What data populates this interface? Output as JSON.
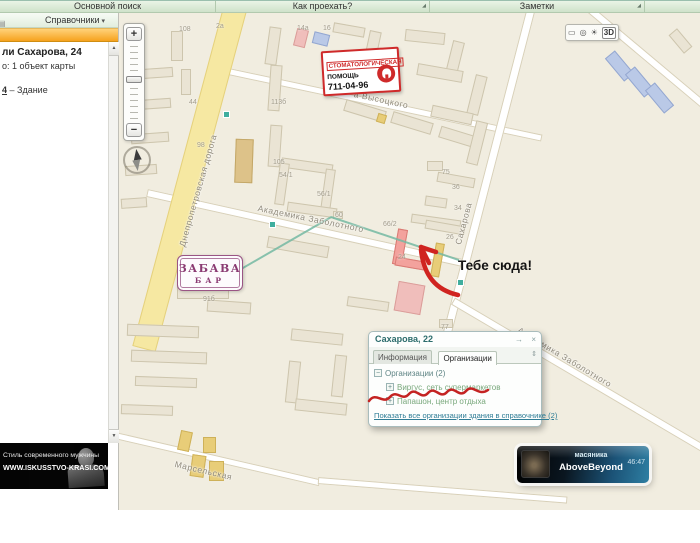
{
  "colors": {
    "accent_orange": "#f6a21d",
    "annotation_red": "#d02420",
    "selection_pink": "#f3a29d",
    "main_road_yellow": "#f6e8a2",
    "org_green": "#79a87c",
    "link_teal": "#2f7d96",
    "player_teal": "#2e7fa3"
  },
  "icons": {
    "launcher": "◢",
    "panel": "▤",
    "scroll_up": "▲",
    "scroll_down": "▼",
    "dropdown": "▾",
    "ruler": "▭",
    "dial": "◎",
    "globe": "☀",
    "route": "→",
    "close": "×",
    "sort": "⇕",
    "group_collapse": "−",
    "group_expand": "+"
  },
  "top_tabs": {
    "items": [
      "Основной поиск",
      "Как проехать?",
      "Заметки"
    ]
  },
  "sidebar": {
    "header": "Справочники",
    "result_title": "ли Сахарова, 24",
    "result_count": "о: 1 объект карты",
    "link_number": "4",
    "link_rest": " – Здание"
  },
  "ad": {
    "line1": "Стиль современного мужчины",
    "line2": "WWW.ISKUSSTVO-KRASI.COM"
  },
  "player": {
    "track": "масяника",
    "artist": "AboveBeyond",
    "time": "46:47"
  },
  "dental": {
    "line1": "СТОМАТОЛОГИЧЕСКАЯ",
    "line2": "ПОМОЩЬ",
    "phone": "711-04-96"
  },
  "zabava": {
    "title": "ЗАБАВА",
    "subtitle": "БАР"
  },
  "annotation": {
    "text": "Тебе сюда!"
  },
  "popup": {
    "title": "Сахарова, 22",
    "tabs": [
      "Информация",
      "Организации"
    ],
    "group_label": "Организации (2)",
    "orgs": [
      "Виргус, сеть супермаркетов",
      "Папашон, центр отдыха"
    ],
    "footer_link": "Показать все организации здания в справочнике (2)"
  },
  "map": {
    "controls": {
      "zoom_in": "+",
      "zoom_out": "−",
      "mode_3d": "3D"
    },
    "streets": [
      {
        "text": "Днепропетровская дорога",
        "x": 58,
        "y": 232,
        "rot": -74
      },
      {
        "text": "а Высоцкого",
        "x": 236,
        "y": 76,
        "rot": 12
      },
      {
        "text": "Академика Заболотного",
        "x": 140,
        "y": 190,
        "rot": 11.5
      },
      {
        "text": "Сахарова",
        "x": 334,
        "y": 230,
        "rot": -75
      },
      {
        "text": "Академика Заболотного",
        "x": 402,
        "y": 312,
        "rot": 31
      },
      {
        "text": "Марсельская",
        "x": 57,
        "y": 446,
        "rot": 13
      }
    ],
    "numbers": [
      {
        "t": "108",
        "x": 60,
        "y": 13
      },
      {
        "t": "2а",
        "x": 97,
        "y": 10
      },
      {
        "t": "14а",
        "x": 178,
        "y": 12
      },
      {
        "t": "16",
        "x": 204,
        "y": 12
      },
      {
        "t": "44",
        "x": 70,
        "y": 86
      },
      {
        "t": "98",
        "x": 78,
        "y": 129
      },
      {
        "t": "113б",
        "x": 152,
        "y": 86
      },
      {
        "t": "105",
        "x": 154,
        "y": 146
      },
      {
        "t": "54/1",
        "x": 160,
        "y": 159
      },
      {
        "t": "56/1",
        "x": 198,
        "y": 178
      },
      {
        "t": "60",
        "x": 216,
        "y": 199
      },
      {
        "t": "75",
        "x": 323,
        "y": 156
      },
      {
        "t": "36",
        "x": 333,
        "y": 171
      },
      {
        "t": "34",
        "x": 335,
        "y": 192
      },
      {
        "t": "26",
        "x": 327,
        "y": 221
      },
      {
        "t": "66/2",
        "x": 264,
        "y": 208
      },
      {
        "t": "24",
        "x": 279,
        "y": 241
      },
      {
        "t": "77",
        "x": 322,
        "y": 311
      },
      {
        "t": "91б",
        "x": 84,
        "y": 283
      }
    ],
    "roads": [
      [
        100,
        56,
        330,
        12,
        7,
        "w"
      ],
      [
        28,
        180,
        325,
        12.5,
        8,
        "w"
      ],
      [
        412,
        -4,
        336,
        104.5,
        9,
        "w"
      ],
      [
        334,
        288,
        340,
        30.5,
        8,
        "w"
      ],
      [
        -4,
        422,
        210,
        13,
        7,
        "w"
      ],
      [
        199,
        467,
        250,
        4.5,
        7,
        "w"
      ],
      [
        468,
        -6,
        155,
        40,
        8,
        "w"
      ],
      [
        116,
        -4,
        352,
        105,
        24,
        "y"
      ]
    ],
    "buildings": [
      [
        52,
        18,
        12,
        30,
        0,
        "c"
      ],
      [
        22,
        55,
        32,
        10,
        -4,
        "c"
      ],
      [
        62,
        56,
        10,
        26,
        0,
        "c"
      ],
      [
        16,
        86,
        36,
        10,
        -4,
        "c"
      ],
      [
        12,
        120,
        38,
        10,
        -4,
        "c"
      ],
      [
        6,
        152,
        32,
        10,
        -4,
        "c"
      ],
      [
        2,
        185,
        26,
        10,
        -4,
        "c"
      ],
      [
        148,
        14,
        12,
        38,
        8,
        "c"
      ],
      [
        176,
        16,
        12,
        18,
        14,
        "p"
      ],
      [
        194,
        20,
        16,
        12,
        14,
        "b"
      ],
      [
        214,
        12,
        32,
        10,
        10,
        "c"
      ],
      [
        248,
        18,
        12,
        28,
        12,
        "c"
      ],
      [
        225,
        92,
        42,
        12,
        17,
        "c"
      ],
      [
        272,
        104,
        42,
        12,
        17,
        "c"
      ],
      [
        320,
        118,
        38,
        12,
        17,
        "c"
      ],
      [
        258,
        101,
        9,
        9,
        17,
        "y"
      ],
      [
        150,
        52,
        12,
        46,
        4,
        "c"
      ],
      [
        150,
        112,
        12,
        42,
        4,
        "c"
      ],
      [
        116,
        126,
        18,
        44,
        2,
        "t"
      ],
      [
        162,
        148,
        52,
        10,
        8,
        "c"
      ],
      [
        158,
        150,
        10,
        42,
        8,
        "c"
      ],
      [
        204,
        156,
        10,
        42,
        8,
        "c"
      ],
      [
        168,
        192,
        50,
        10,
        8,
        "c"
      ],
      [
        214,
        198,
        10,
        8,
        0,
        "c"
      ],
      [
        148,
        228,
        62,
        12,
        10,
        "c"
      ],
      [
        228,
        286,
        42,
        10,
        8,
        "c"
      ],
      [
        58,
        252,
        52,
        34,
        0,
        "c"
      ],
      [
        88,
        288,
        44,
        12,
        4,
        "c"
      ],
      [
        8,
        312,
        72,
        12,
        2,
        "c"
      ],
      [
        12,
        338,
        76,
        12,
        2,
        "c"
      ],
      [
        16,
        364,
        62,
        10,
        2,
        "c"
      ],
      [
        2,
        392,
        52,
        10,
        2,
        "c"
      ],
      [
        60,
        418,
        12,
        20,
        12,
        "y"
      ],
      [
        72,
        442,
        14,
        22,
        8,
        "y"
      ],
      [
        84,
        424,
        13,
        16,
        0,
        "y"
      ],
      [
        90,
        448,
        15,
        20,
        0,
        "y"
      ],
      [
        286,
        18,
        40,
        12,
        6,
        "c"
      ],
      [
        330,
        28,
        12,
        34,
        14,
        "c"
      ],
      [
        298,
        54,
        46,
        12,
        10,
        "c"
      ],
      [
        352,
        62,
        12,
        40,
        14,
        "c"
      ],
      [
        312,
        96,
        42,
        12,
        12,
        "c"
      ],
      [
        352,
        108,
        12,
        44,
        14,
        "c"
      ],
      [
        308,
        148,
        16,
        10,
        0,
        "c"
      ],
      [
        318,
        162,
        38,
        10,
        10,
        "c"
      ],
      [
        306,
        184,
        22,
        10,
        8,
        "c"
      ],
      [
        292,
        204,
        50,
        9,
        8,
        "c"
      ],
      [
        306,
        210,
        40,
        9,
        10,
        "c"
      ],
      [
        276,
        216,
        10,
        36,
        10,
        "sel"
      ],
      [
        276,
        246,
        30,
        9,
        10,
        "sel"
      ],
      [
        314,
        230,
        9,
        34,
        10,
        "y"
      ],
      [
        277,
        270,
        27,
        30,
        10,
        "p"
      ],
      [
        320,
        306,
        14,
        9,
        0,
        "c"
      ],
      [
        172,
        318,
        52,
        12,
        6,
        "c"
      ],
      [
        168,
        348,
        12,
        42,
        6,
        "c"
      ],
      [
        214,
        342,
        12,
        42,
        6,
        "c"
      ],
      [
        176,
        388,
        52,
        12,
        6,
        "c"
      ],
      [
        494,
        38,
        13,
        30,
        -40,
        "b"
      ],
      [
        514,
        54,
        13,
        30,
        -40,
        "b"
      ],
      [
        534,
        70,
        13,
        30,
        -40,
        "b"
      ],
      [
        556,
        16,
        11,
        24,
        -40,
        "c"
      ]
    ],
    "route": [
      [
        117,
        258,
        110,
        -30
      ],
      [
        212,
        203,
        135,
        18.6
      ]
    ],
    "stops": [
      [
        104,
        98
      ],
      [
        150,
        208
      ],
      [
        338,
        266
      ]
    ]
  }
}
